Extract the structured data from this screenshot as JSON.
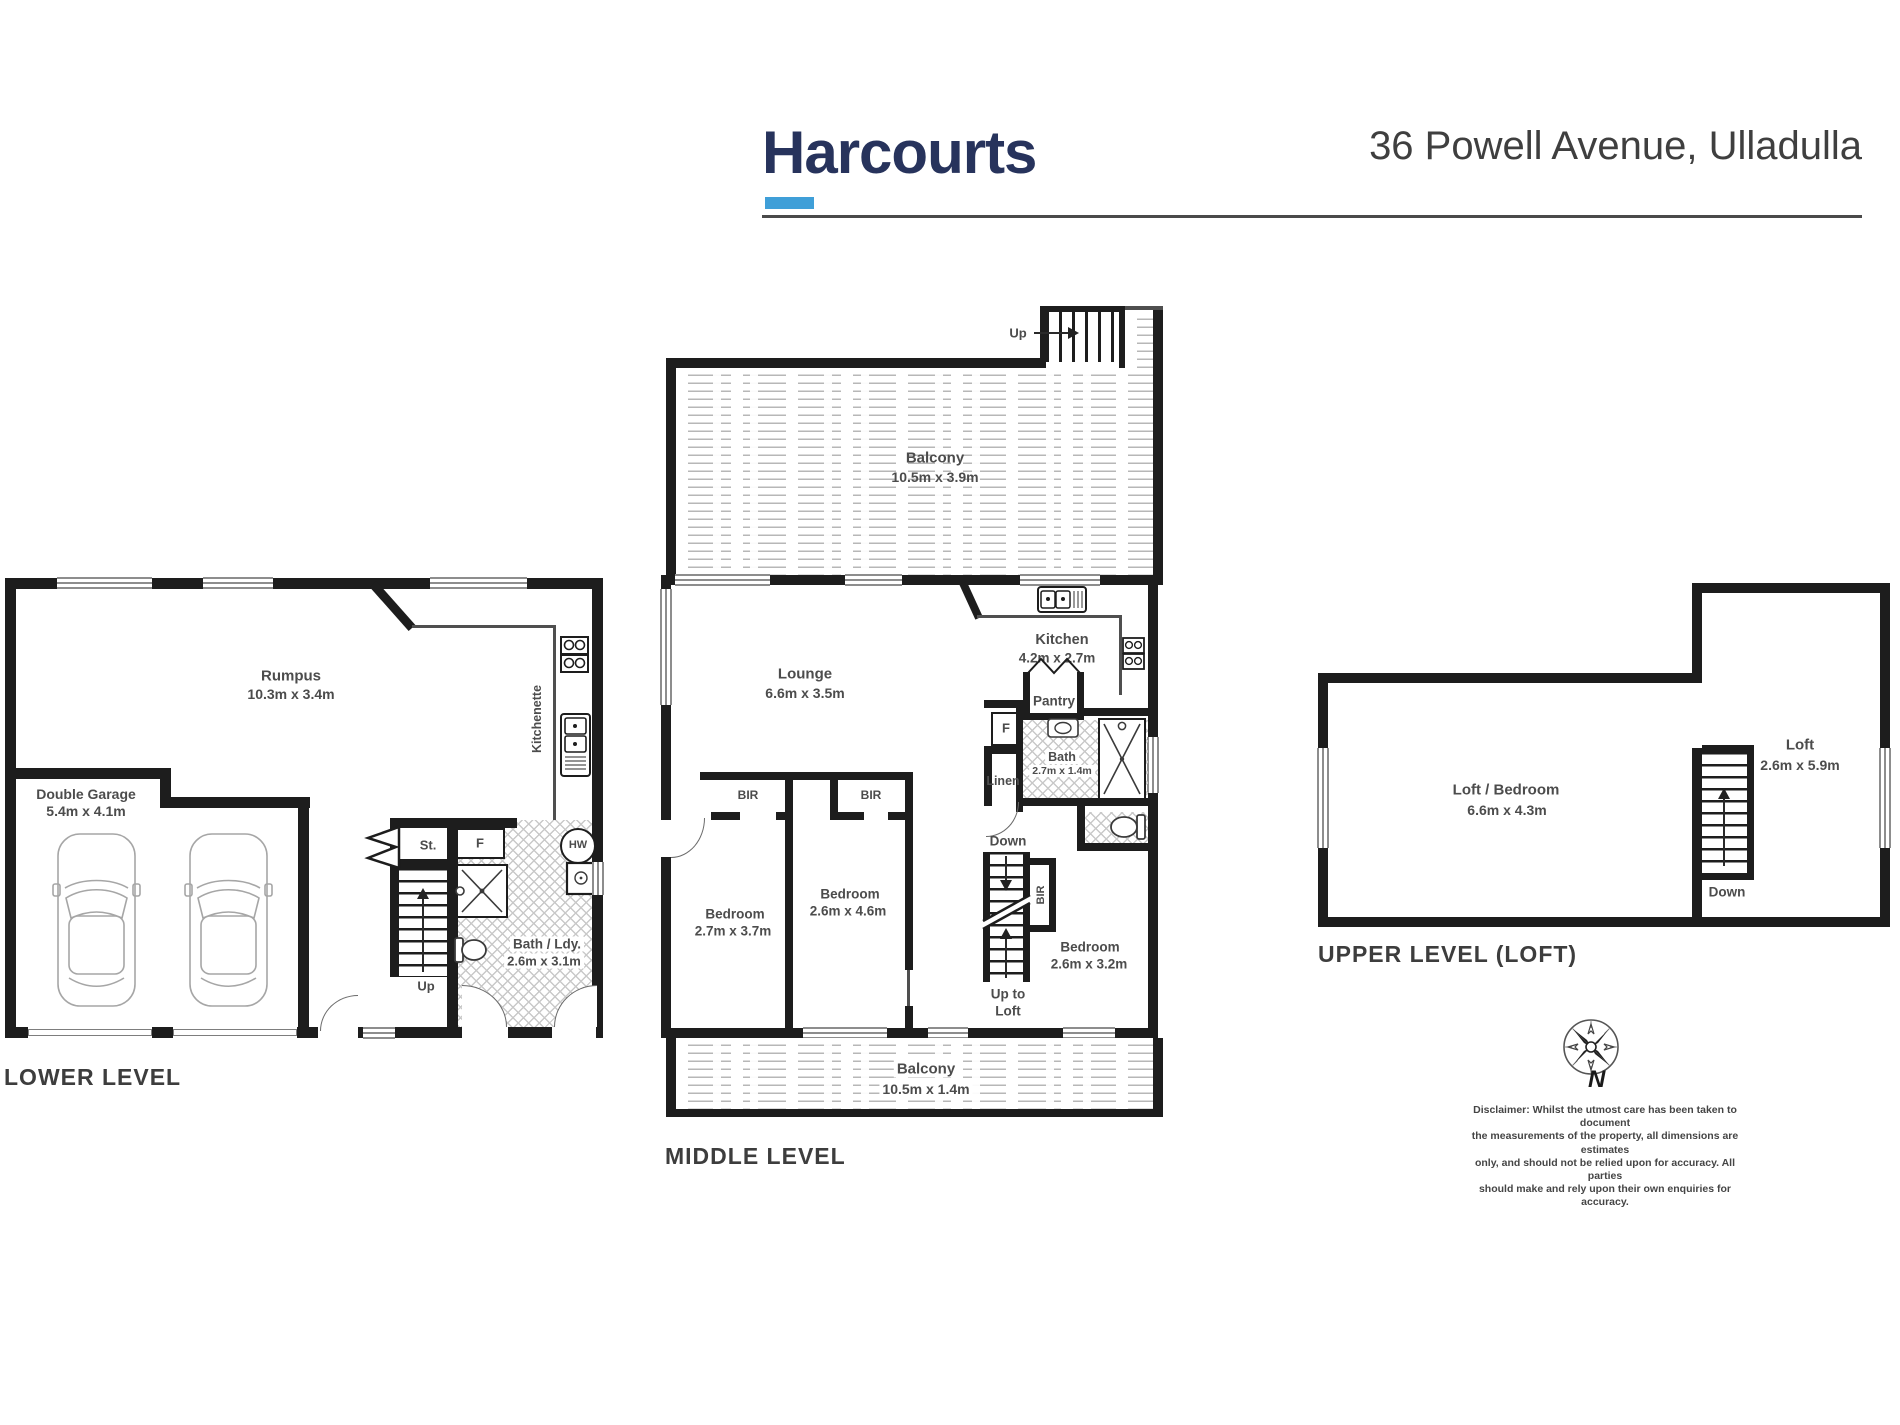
{
  "header": {
    "logo_text": "Harcourts",
    "address": "36 Powell Avenue, Ulladulla",
    "logo_color": "#27335c",
    "accent_color": "#3f9fd8"
  },
  "lower": {
    "level_label": "LOWER LEVEL",
    "rumpus_name": "Rumpus",
    "rumpus_dims": "10.3m x 3.4m",
    "garage_name": "Double Garage",
    "garage_dims": "5.4m x 4.1m",
    "bath_name": "Bath / Ldy.",
    "bath_dims": "2.6m x 3.1m",
    "kitchenette": "Kitchenette",
    "storage": "St.",
    "fridge": "F",
    "hot_water": "HW",
    "up": "Up"
  },
  "middle": {
    "level_label": "MIDDLE LEVEL",
    "balcony_top_name": "Balcony",
    "balcony_top_dims": "10.5m x 3.9m",
    "balcony_bottom_name": "Balcony",
    "balcony_bottom_dims": "10.5m x 1.4m",
    "up": "Up",
    "lounge_name": "Lounge",
    "lounge_dims": "6.6m x 3.5m",
    "kitchen_name": "Kitchen",
    "kitchen_dims": "4.2m x 2.7m",
    "pantry": "Pantry",
    "fridge": "F",
    "linen": "Linen",
    "down": "Down",
    "bath_name": "Bath",
    "bath_dims": "2.7m x 1.4m",
    "bir1": "BIR",
    "bir2": "BIR",
    "bir3": "BIR",
    "bed1_name": "Bedroom",
    "bed1_dims": "2.7m x 3.7m",
    "bed2_name": "Bedroom",
    "bed2_dims": "2.6m x 4.6m",
    "bed3_name": "Bedroom",
    "bed3_dims": "2.6m x 3.2m",
    "up_to_loft_line1": "Up to",
    "up_to_loft_line2": "Loft"
  },
  "upper": {
    "level_label": "UPPER LEVEL (LOFT)",
    "loft_bedroom_name": "Loft / Bedroom",
    "loft_bedroom_dims": "6.6m x 4.3m",
    "loft_name": "Loft",
    "loft_dims": "2.6m x 5.9m",
    "down": "Down"
  },
  "compass": {
    "north": "N"
  },
  "disclaimer": {
    "line1": "Disclaimer: Whilst the utmost care has been taken to document",
    "line2": "the measurements of the property, all dimensions are estimates",
    "line3": "only, and should not be relied upon for accuracy.  All parties",
    "line4": "should make and rely upon their own enquiries for accuracy."
  }
}
